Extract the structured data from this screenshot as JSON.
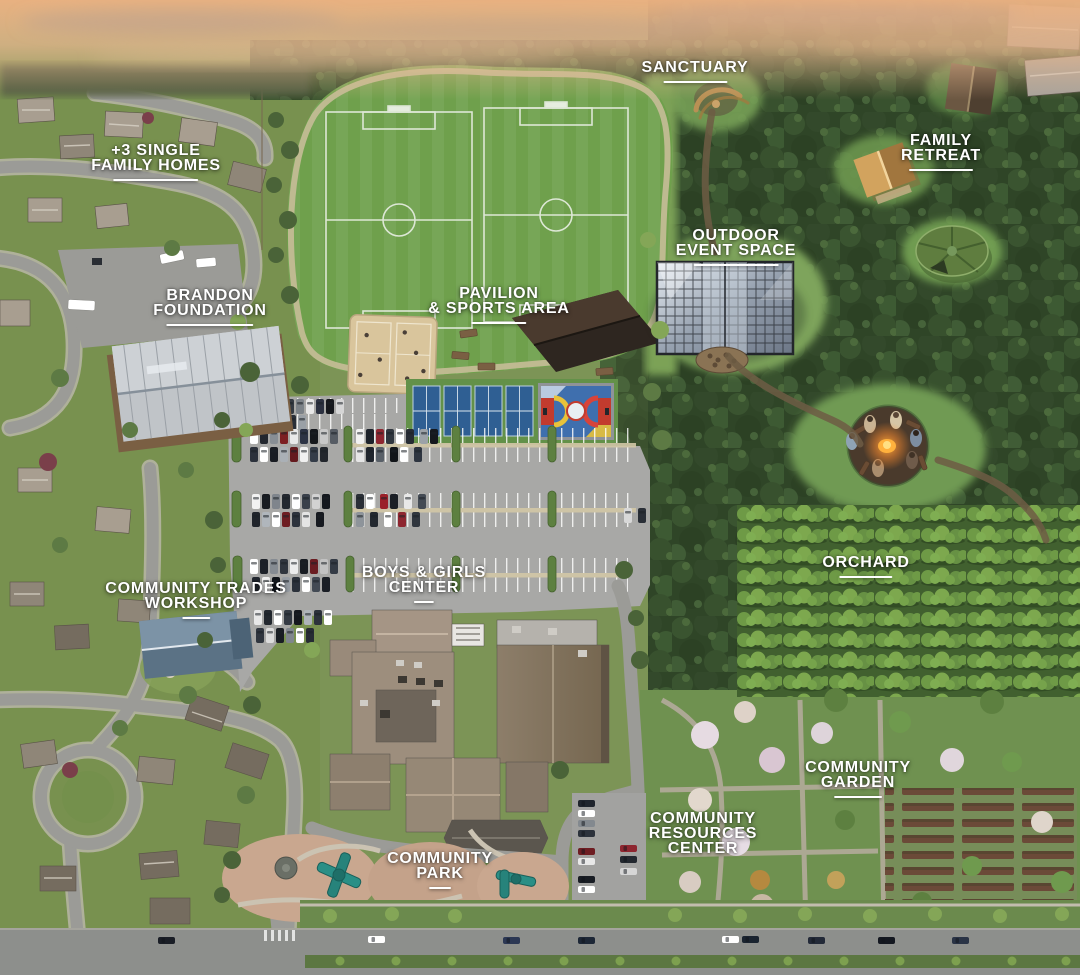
{
  "map": {
    "type": "aerial-campus-site-map",
    "labels": {
      "single_family_homes": {
        "line1": "+3 SINGLE",
        "line2": "FAMILY HOMES"
      },
      "sanctuary": {
        "line1": "SANCTUARY"
      },
      "family_retreat": {
        "line1": "FAMILY",
        "line2": "RETREAT"
      },
      "outdoor_event_space": {
        "line1": "OUTDOOR",
        "line2": "EVENT SPACE"
      },
      "brandon_foundation": {
        "line1": "BRANDON",
        "line2": "FOUNDATION"
      },
      "pavilion_sports_area": {
        "line1": "PAVILION",
        "line2": "& SPORTS AREA"
      },
      "community_trades_workshop": {
        "line1": "COMMUNITY TRADES",
        "line2": "WORKSHOP"
      },
      "boys_girls_center": {
        "line1": "BOYS & GIRLS",
        "line2": "CENTER"
      },
      "orchard": {
        "line1": "ORCHARD"
      },
      "community_garden": {
        "line1": "COMMUNITY",
        "line2": "GARDEN"
      },
      "community_resources_center": {
        "line1": "COMMUNITY",
        "line2": "RESOURCES",
        "line3": "CENTER"
      },
      "community_park": {
        "line1": "COMMUNITY",
        "line2": "PARK"
      }
    },
    "colors": {
      "label_text": "#ffffff",
      "field_green": "#6fa04c",
      "forest_green": "#2f4527",
      "parking_gray": "#a8a8a6",
      "court_blue": "#2f5f93",
      "sand_tan": "#d9c59c",
      "roof_tan": "#9d8e7d",
      "fire_orange": "#ff9d2e",
      "sky_peach": "#ecb282"
    }
  }
}
